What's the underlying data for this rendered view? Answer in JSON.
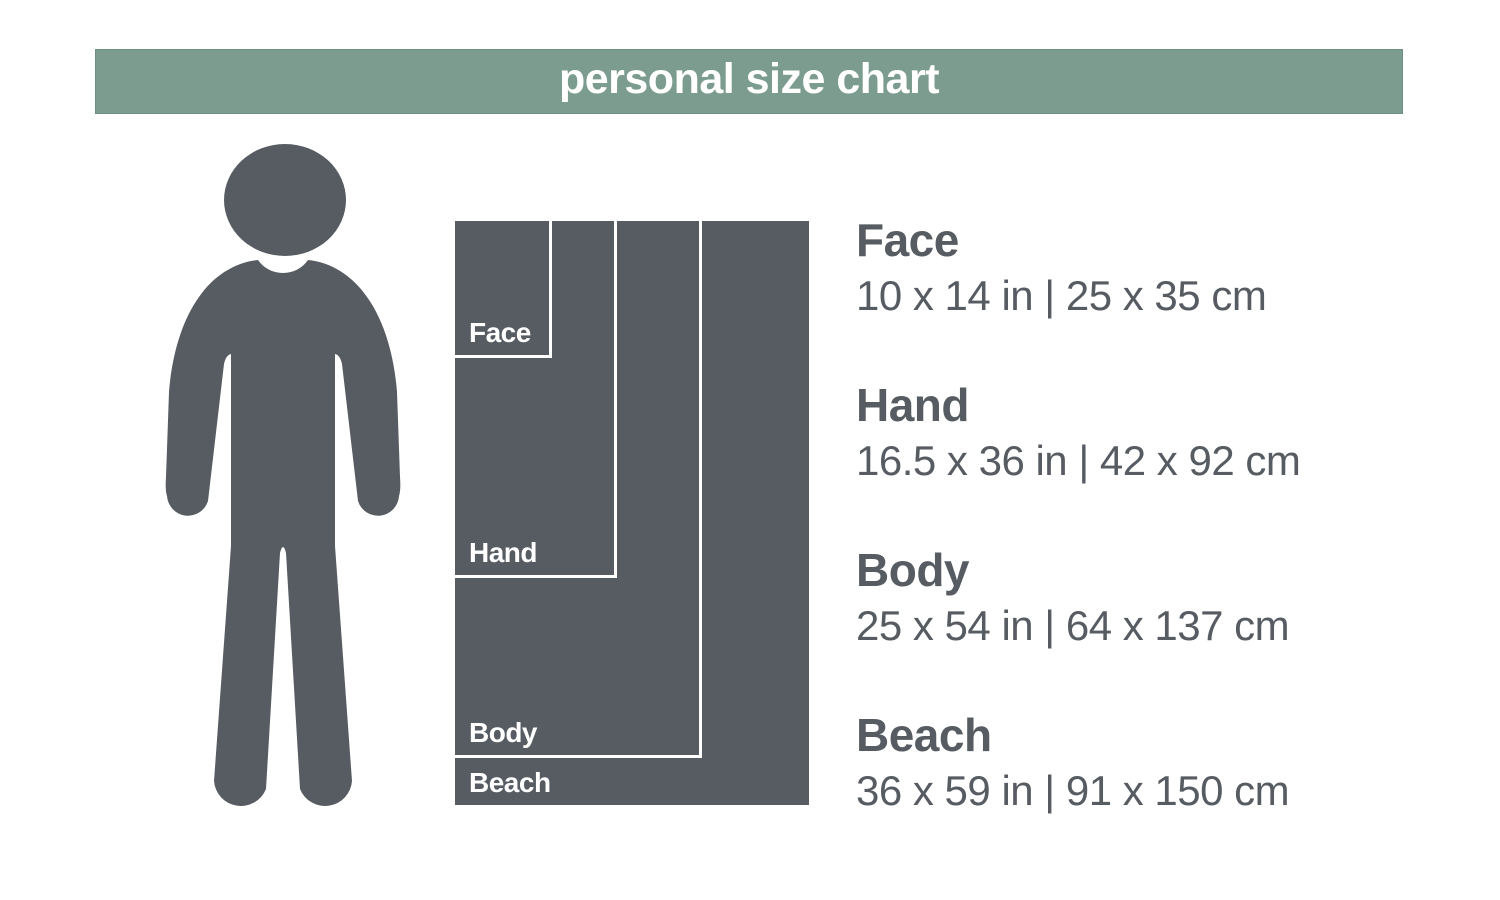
{
  "title": "personal size chart",
  "colors": {
    "header-bg": "#7b9c8f",
    "header-border": "#6e9082",
    "ink": "#565c61",
    "label": "#ffffff"
  },
  "sizes": [
    {
      "key": "face",
      "label": "Face",
      "dims": "10 x 14 in | 25 x 35 cm",
      "width_in": 10,
      "height_in": 14
    },
    {
      "key": "hand",
      "label": "Hand",
      "dims": "16.5 x 36 in | 42 x 92 cm",
      "width_in": 16.5,
      "height_in": 36
    },
    {
      "key": "body",
      "label": "Body",
      "dims": "25 x 54 in | 64 x 137 cm",
      "width_in": 25,
      "height_in": 54
    },
    {
      "key": "beach",
      "label": "Beach",
      "dims": "36 x 59 in | 91 x 150 cm",
      "width_in": 36,
      "height_in": 59
    }
  ]
}
